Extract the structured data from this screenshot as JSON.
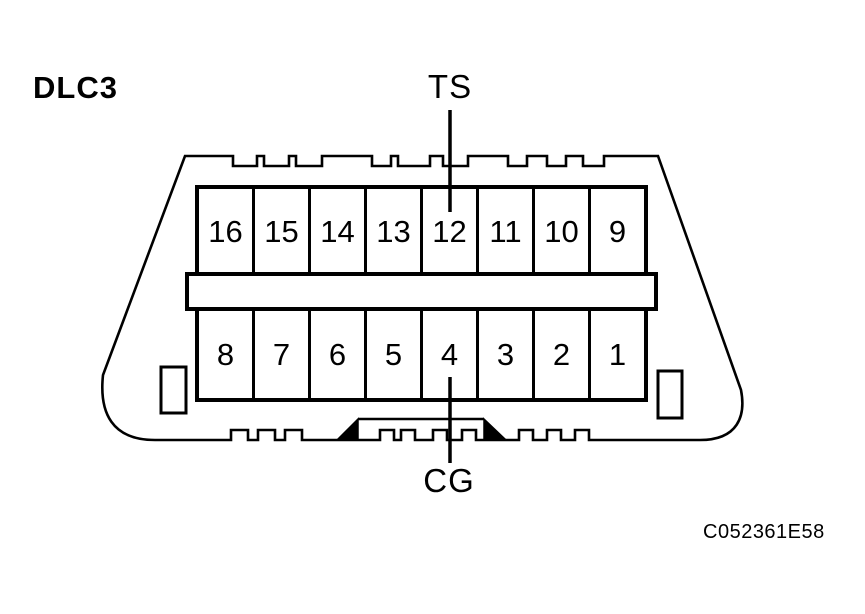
{
  "page": {
    "background_color": "#ffffff",
    "line_color": "#000000"
  },
  "header": {
    "title": "DLC3"
  },
  "connector": {
    "name": "DLC3 16-pin diagnostic connector",
    "top_terminal_label": "TS",
    "bottom_terminal_label": "CG",
    "top_row_pins": [
      "16",
      "15",
      "14",
      "13",
      "12",
      "11",
      "10",
      "9"
    ],
    "bottom_row_pins": [
      "8",
      "7",
      "6",
      "5",
      "4",
      "3",
      "2",
      "1"
    ],
    "ts_points_to_pin": "12",
    "cg_points_to_pin": "4"
  },
  "footer": {
    "figure_code": "C052361E58"
  }
}
